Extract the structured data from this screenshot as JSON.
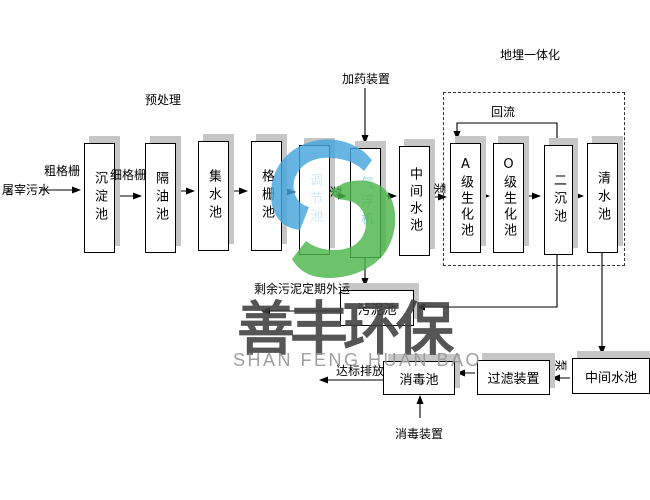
{
  "watermark": {
    "brand_cn": "善丰环保",
    "brand_en": "SHAN FENG HUAN BAO",
    "logo_blue": "#45a6de",
    "logo_green": "#4cb64c"
  },
  "labels": {
    "influent": "屠宰污水",
    "coarse_screen": "粗格栅",
    "fine_screen": "细格栅",
    "pretreatment": "预处理",
    "dosing_device": "加药装置",
    "buried_integration": "地埋一体化",
    "reflux": "回流",
    "pump": "泵",
    "excess_sludge_out": "剩余污泥定期外运",
    "discharge": "达标排放",
    "disinfection_device": "消毒装置"
  },
  "process_tanks": [
    {
      "id": "sedimentation",
      "label": "沉淀池"
    },
    {
      "id": "oil-separation",
      "label": "隔油池"
    },
    {
      "id": "collection",
      "label": "集水池"
    },
    {
      "id": "grid",
      "label": "格栅池"
    },
    {
      "id": "regulating",
      "label": "调节池"
    },
    {
      "id": "air-flotation",
      "label": "气浮机"
    },
    {
      "id": "intermediate-1",
      "label": "中间水池"
    },
    {
      "id": "a-biochemical",
      "label": "A级生化池"
    },
    {
      "id": "o-biochemical",
      "label": "O级生化池"
    },
    {
      "id": "secondary-sedimentation",
      "label": "二沉池"
    },
    {
      "id": "clear-water",
      "label": "清水池"
    }
  ],
  "bottom_tanks": [
    {
      "id": "sludge",
      "label": "污泥池"
    },
    {
      "id": "disinfection",
      "label": "消毒池"
    },
    {
      "id": "filter-device",
      "label": "过滤装置"
    },
    {
      "id": "intermediate-2",
      "label": "中间水池"
    }
  ],
  "colors": {
    "box_border": "#000000",
    "box_shadow": "#c6c6c6",
    "line": "#000000",
    "watermark_cn": "#3e3e3e",
    "watermark_en": "#979797"
  }
}
